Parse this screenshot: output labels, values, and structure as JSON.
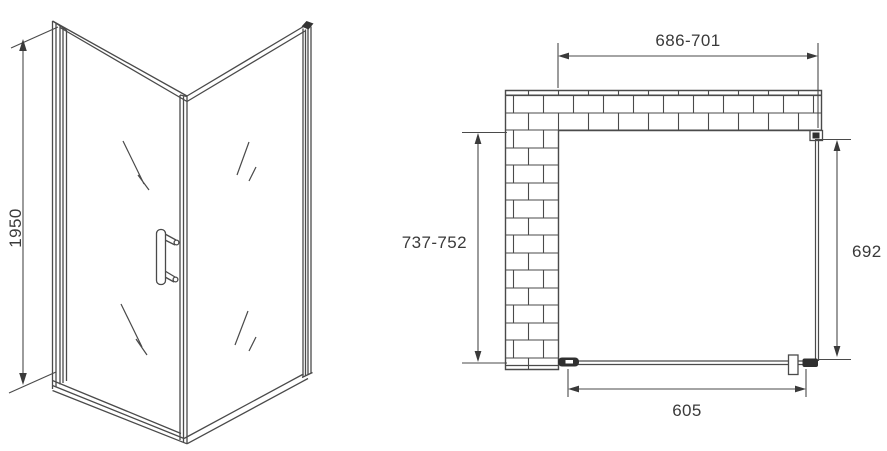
{
  "labels": {
    "height": "1950",
    "top_width": "686-701",
    "left_depth": "737-752",
    "right_depth": "692",
    "door_width": "605"
  },
  "colors": {
    "line": "#4a4a4a",
    "text": "#3a3a3a",
    "dark_detail": "#2f2f2f",
    "background": "#ffffff"
  }
}
